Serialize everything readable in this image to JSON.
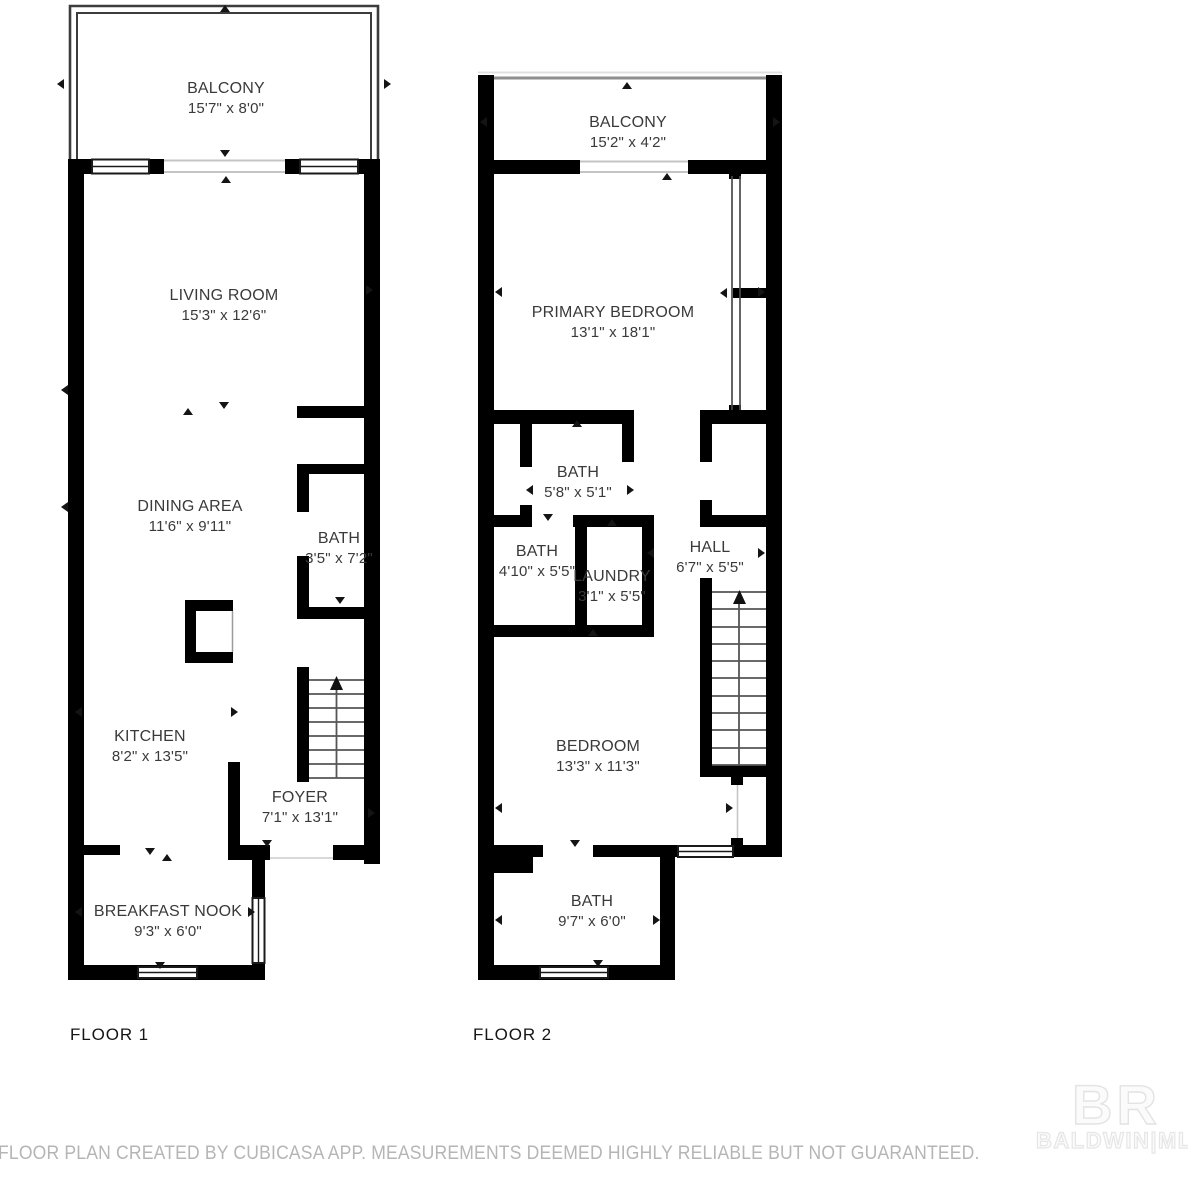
{
  "floor1": {
    "label": "FLOOR 1",
    "rooms": [
      {
        "name": "BALCONY",
        "dims": "15'7\" x 8'0\""
      },
      {
        "name": "LIVING ROOM",
        "dims": "15'3\" x 12'6\""
      },
      {
        "name": "DINING AREA",
        "dims": "11'6\" x 9'11\""
      },
      {
        "name": "BATH",
        "dims": "3'5\" x 7'2\""
      },
      {
        "name": "KITCHEN",
        "dims": "8'2\" x 13'5\""
      },
      {
        "name": "FOYER",
        "dims": "7'1\" x 13'1\""
      },
      {
        "name": "BREAKFAST NOOK",
        "dims": "9'3\" x 6'0\""
      }
    ]
  },
  "floor2": {
    "label": "FLOOR 2",
    "rooms": [
      {
        "name": "BALCONY",
        "dims": "15'2\" x 4'2\""
      },
      {
        "name": "PRIMARY BEDROOM",
        "dims": "13'1\" x 18'1\""
      },
      {
        "name": "BATH",
        "dims": "5'8\" x 5'1\""
      },
      {
        "name": "BATH",
        "dims": "4'10\" x 5'5\""
      },
      {
        "name": "LAUNDRY",
        "dims": "3'1\" x 5'5\""
      },
      {
        "name": "HALL",
        "dims": "6'7\" x 5'5\""
      },
      {
        "name": "BEDROOM",
        "dims": "13'3\" x 11'3\""
      },
      {
        "name": "BATH",
        "dims": "9'7\" x 6'0\""
      }
    ]
  },
  "footer": {
    "disclaimer": "FLOOR PLAN CREATED BY CUBICASA APP. MEASUREMENTS DEEMED HIGHLY RELIABLE BUT NOT GUARANTEED."
  },
  "watermark": {
    "logo": "BR",
    "label": "BALDWIN|MLS"
  },
  "colors": {
    "wall": "#000000",
    "label_text": "#3a3a3a",
    "disclaimer_text": "#b5b5b5"
  }
}
